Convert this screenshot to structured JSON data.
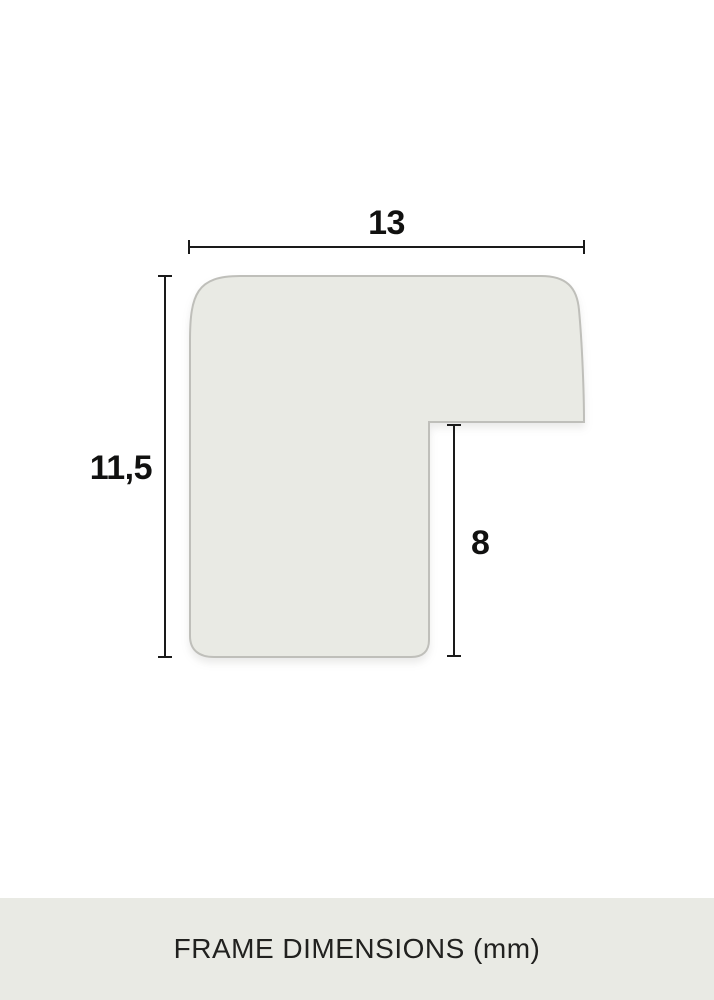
{
  "diagram": {
    "width_label": "13",
    "height_label": "11,5",
    "rabbet_height_label": "8",
    "shape_fill": "#e9eae4",
    "shape_stroke": "#bfbfba",
    "dimension_line_color": "#1a1a1a"
  },
  "footer": {
    "label": "FRAME DIMENSIONS (mm)",
    "background": "#e9eae4",
    "text_color": "#21211f"
  }
}
